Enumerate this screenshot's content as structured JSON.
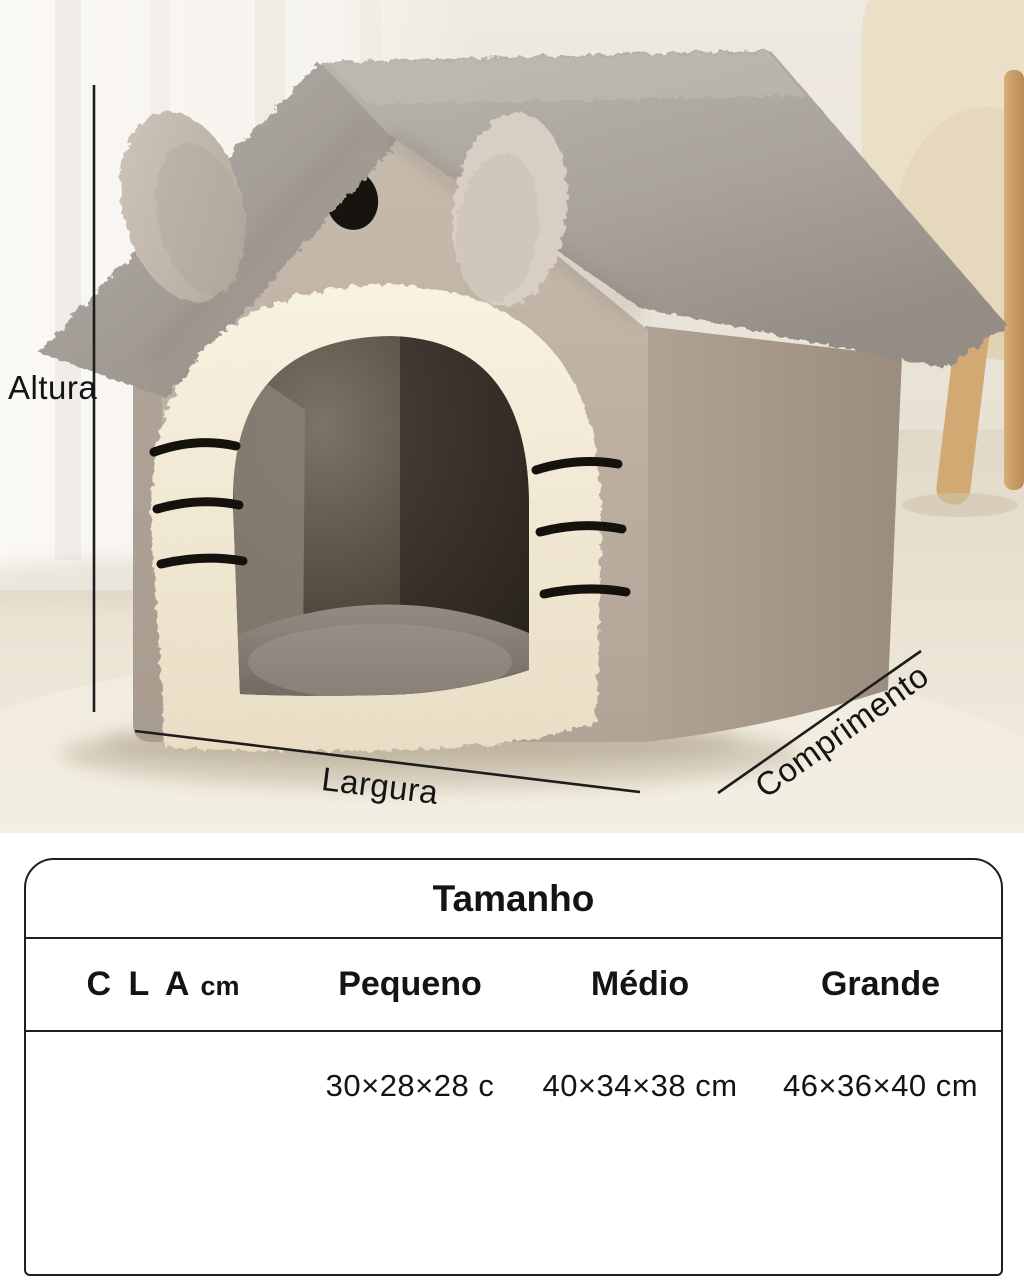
{
  "product_photo": {
    "dimension_labels": {
      "altura": "Altura",
      "largura": "Largura",
      "comprimento": "Comprimento"
    },
    "colors": {
      "annotation_line": "#1d1d1d",
      "roof": "#a9a39c",
      "house_body": "#bdb1a4",
      "door_trim": "#f3ecd9",
      "interior_dark": "#3d352c",
      "wall": "#eae4d9",
      "floor": "#ece5d7",
      "curtain": "#f7f5f1",
      "armchair": "#ebdfc8",
      "wood": "#c89e66"
    }
  },
  "size_table": {
    "title": "Tamanho",
    "header": {
      "dimension_letters": "C L A",
      "dimension_unit": "cm",
      "size_columns": [
        "Pequeno",
        "Médio",
        "Grande"
      ]
    },
    "rows": [
      {
        "cells": [
          "30×28×28 c",
          "40×34×38 cm",
          "46×36×40 cm"
        ]
      }
    ]
  }
}
